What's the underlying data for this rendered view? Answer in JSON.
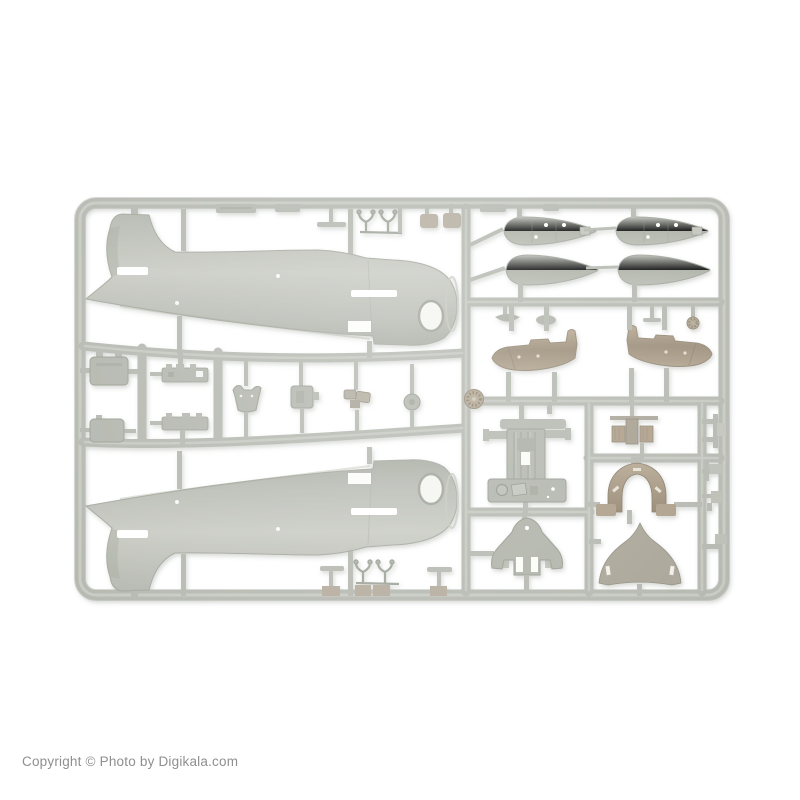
{
  "watermark": {
    "text": "Copyright © Photo by Digikala.com"
  },
  "photo": {
    "alt": "Product photo of a light grey injection-moulded plastic model-kit sprue on a white background, holding two aircraft fuselage halves, four drop-tank halves, two tailplanes, cockpit floor, instrument panel, engine block, cowl arch, landing-gear bulkhead, dome fairing and many small fittings",
    "colors": {
      "background": "#ffffff",
      "plastic": "#b2b5ad",
      "plastic_light": "#c8cac3",
      "plastic_dark": "#989c92",
      "tan": "#ab9a83",
      "tan_dark": "#8f8069",
      "shadow": "#70756a",
      "watermark": "#8f8f8f"
    }
  }
}
